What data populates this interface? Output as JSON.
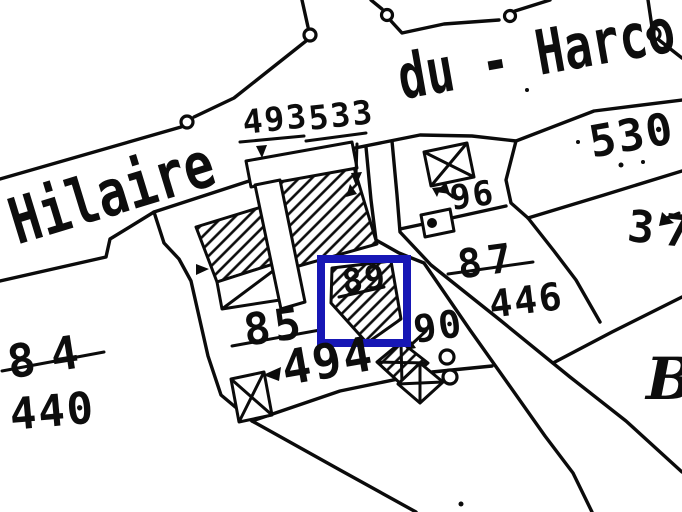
{
  "map": {
    "street": {
      "left": "Hilaire",
      "right": "du - Harco"
    },
    "section": {
      "letter": "B"
    },
    "selection": {
      "color": "#1717b5",
      "highlighted_parcel": "89"
    },
    "parcels": {
      "p493": "493",
      "p533": "533",
      "p530": "530",
      "p37": "37",
      "p96": "96",
      "p87": "87",
      "p446": "446",
      "p89": "89",
      "p90": "90",
      "p85": "85",
      "p494": "494",
      "p84": "84",
      "p440": "440"
    },
    "struck_parcels": [
      "84",
      "85",
      "87",
      "89"
    ],
    "symbols": {
      "survey_marker": "small-circle",
      "light_building": "crossed-box",
      "building_fill": "diagonal-hatch"
    }
  }
}
